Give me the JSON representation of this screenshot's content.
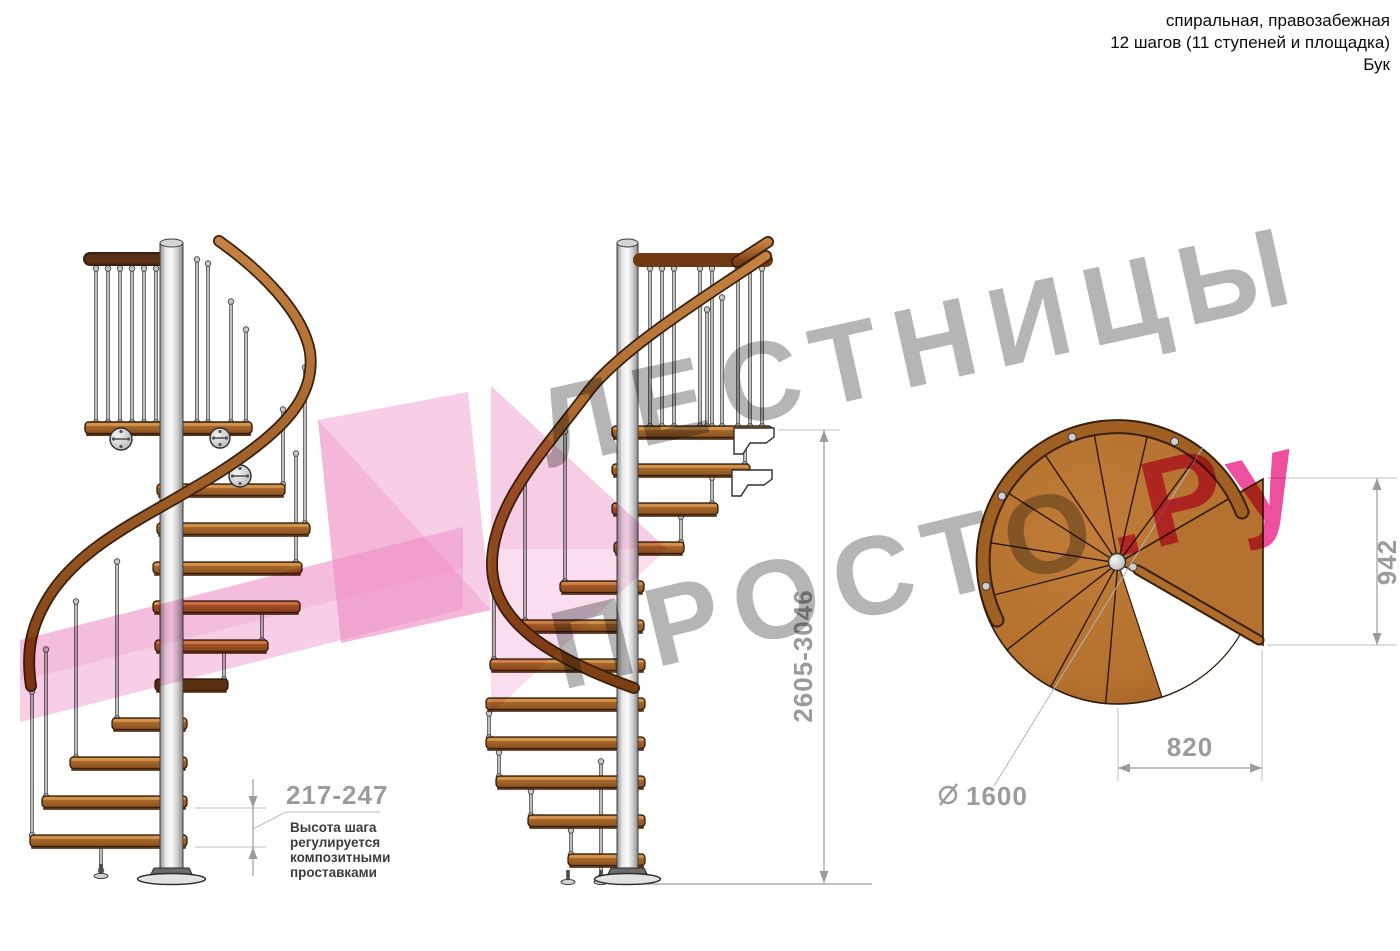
{
  "header": {
    "line1": "спиральная, правозабежная",
    "line2": "12 шагов (11 ступеней и площадка)",
    "line3": "Бук"
  },
  "watermark": {
    "line1": "ЛЕСТНИЦЫ",
    "line2": "ПРОСТО",
    "suffix": ".Ру",
    "gray_color": "#b5b5b5",
    "pink_color": "#ef4f9f",
    "arrow_pink_color": "#f19bce"
  },
  "dimensions": {
    "step_height": "217-247",
    "total_height": "2605-3046",
    "landing_width": "942",
    "landing_depth": "820",
    "diameter_value": "1600",
    "note_line1": "Высота шага",
    "note_line2": "регулируется",
    "note_line3": "композитными",
    "note_line4": "проставками"
  },
  "colors": {
    "wood_step": "#a8682a",
    "wood_light": "#d89a52",
    "wood_dark": "#4e2a0e",
    "handrail": "#8a4a16",
    "plan_wood": "#b4712f",
    "metal_pole": "#d9d9d9",
    "dimension_gray": "#9b9b9b",
    "note_text": "#3c3c3c"
  }
}
